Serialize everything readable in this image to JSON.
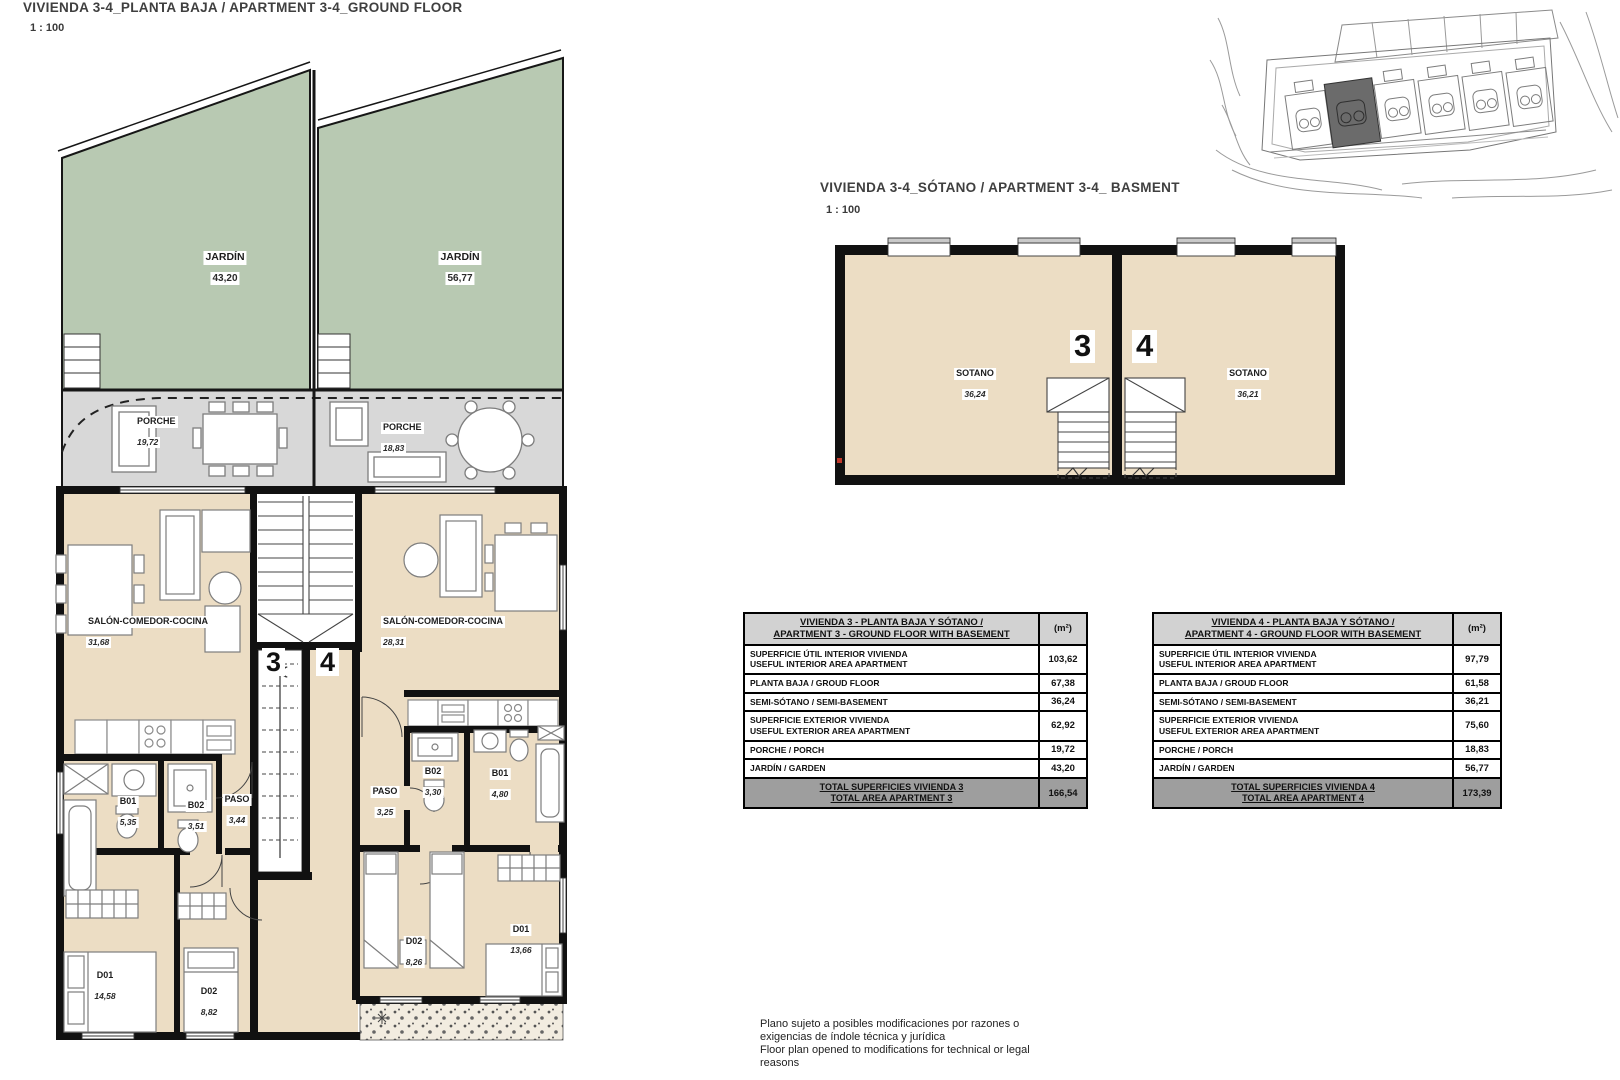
{
  "ground_plan": {
    "title": "VIVIENDA 3-4_PLANTA BAJA / APARTMENT 3-4_GROUND FLOOR",
    "scale": "1 : 100",
    "unit_left": "3",
    "unit_right": "4",
    "rooms": {
      "jardin_left": {
        "name": "JARDÍN",
        "area": "43,20"
      },
      "jardin_right": {
        "name": "JARDÍN",
        "area": "56,77"
      },
      "porche_left": {
        "name": "PORCHE",
        "area": "19,72"
      },
      "porche_right": {
        "name": "PORCHE",
        "area": "18,83"
      },
      "salon_left": {
        "name": "SALÓN-COMEDOR-COCINA",
        "area": "31,68"
      },
      "salon_right": {
        "name": "SALÓN-COMEDOR-COCINA",
        "area": "28,31"
      },
      "b01_left": {
        "name": "B01",
        "area": "5,35"
      },
      "b02_left": {
        "name": "B02",
        "area": "3,51"
      },
      "paso_left": {
        "name": "PASO",
        "area": "3,44"
      },
      "paso_right": {
        "name": "PASO",
        "area": "3,25"
      },
      "b02_right": {
        "name": "B02",
        "area": "3,30"
      },
      "b01_right": {
        "name": "B01",
        "area": "4,80"
      },
      "d01_left": {
        "name": "D01",
        "area": "14,58"
      },
      "d02_left": {
        "name": "D02",
        "area": "8,82"
      },
      "d02_right": {
        "name": "D02",
        "area": "8,26"
      },
      "d01_right": {
        "name": "D01",
        "area": "13,66"
      }
    }
  },
  "basement_plan": {
    "title": "VIVIENDA 3-4_SÓTANO / APARTMENT 3-4_ BASMENT",
    "scale": "1 : 100",
    "unit_left": "3",
    "unit_right": "4",
    "rooms": {
      "sotano_left": {
        "name": "SOTANO",
        "area": "36,24"
      },
      "sotano_right": {
        "name": "SOTANO",
        "area": "36,21"
      }
    }
  },
  "tables": [
    {
      "title": "VIVIENDA 3 - PLANTA BAJA Y SÓTANO /\nAPARTMENT 3 - GROUND FLOOR WITH BASEMENT",
      "unit": "(m²)",
      "rows": [
        {
          "label": "SUPERFICIE ÚTIL INTERIOR VIVIENDA\nUSEFUL INTERIOR AREA APARTMENT",
          "value": "103,62"
        },
        {
          "label": "PLANTA BAJA / GROUD FLOOR",
          "value": "67,38"
        },
        {
          "label": "SEMI-SÓTANO / SEMI-BASEMENT",
          "value": "36,24"
        },
        {
          "label": "SUPERFICIE EXTERIOR VIVIENDA\nUSEFUL EXTERIOR AREA APARTMENT",
          "value": "62,92"
        },
        {
          "label": "PORCHE / PORCH",
          "value": "19,72"
        },
        {
          "label": "JARDÍN / GARDEN",
          "value": "43,20"
        }
      ],
      "total_label": "TOTAL SUPERFICIES VIVIENDA 3\nTOTAL AREA APARTMENT 3",
      "total_value": "166,54"
    },
    {
      "title": "VIVIENDA 4 - PLANTA BAJA Y SÓTANO /\nAPARTMENT 4 - GROUND FLOOR WITH BASEMENT",
      "unit": "(m²)",
      "rows": [
        {
          "label": "SUPERFICIE ÚTIL INTERIOR VIVIENDA\nUSEFUL INTERIOR AREA APARTMENT",
          "value": "97,79"
        },
        {
          "label": "PLANTA BAJA / GROUD FLOOR",
          "value": "61,58"
        },
        {
          "label": "SEMI-SÓTANO / SEMI-BASEMENT",
          "value": "36,21"
        },
        {
          "label": "SUPERFICIE EXTERIOR VIVIENDA\nUSEFUL EXTERIOR AREA APARTMENT",
          "value": "75,60"
        },
        {
          "label": "PORCHE / PORCH",
          "value": "18,83"
        },
        {
          "label": "JARDÍN / GARDEN",
          "value": "56,77"
        }
      ],
      "total_label": "TOTAL SUPERFICIES VIVIENDA 4\nTOTAL AREA APARTMENT 4",
      "total_value": "173,39"
    }
  ],
  "disclaimer": {
    "text": "Plano sujeto a posibles modificaciones por razones o\nexigencias de índole técnica y jurídica\nFloor plan opened to modifications for technical or legal\nreasons"
  },
  "colors": {
    "garden": "#b8c9b2",
    "porch": "#d8d8d8",
    "floor": "#ecddc4",
    "wall": "#111111",
    "table_header_bg": "#d2d2d2",
    "table_total_bg": "#9e9e9e"
  }
}
